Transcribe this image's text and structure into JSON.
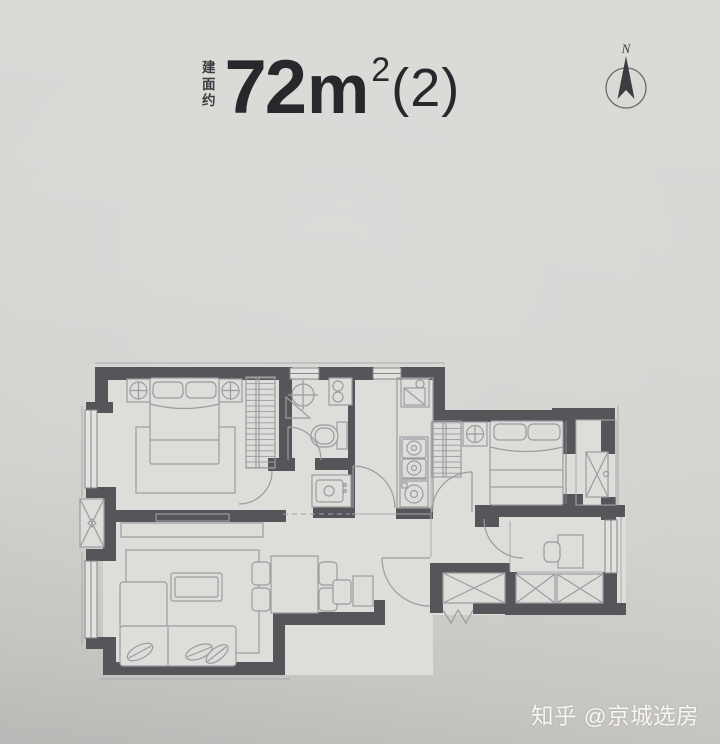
{
  "title": {
    "prefix_chars": [
      "建",
      "面",
      "约"
    ],
    "value": "72",
    "unit": "m",
    "exponent": "2",
    "variant": "(2)"
  },
  "compass": {
    "label": "N"
  },
  "watermark": {
    "text": "知乎 @京城选房"
  },
  "colors": {
    "wall": "#55555a",
    "line": "#9b9ba1",
    "floor": "#deddd9",
    "title": "#28282c",
    "wm": "#f7f6f3"
  },
  "icons": [
    "north-compass-icon",
    "double-bed-icon",
    "nightstand-lamp-icon",
    "wardrobe-icon",
    "toilet-icon",
    "shower-icon",
    "vanity-sink-icon",
    "kitchen-sink-icon",
    "stove-icon",
    "washing-machine-icon",
    "sofa-icon",
    "coffee-table-icon",
    "tv-console-icon",
    "dining-table-icon",
    "desk-icon",
    "ac-unit-icon",
    "elevator-shaft-icon",
    "storage-shaft-icon"
  ]
}
